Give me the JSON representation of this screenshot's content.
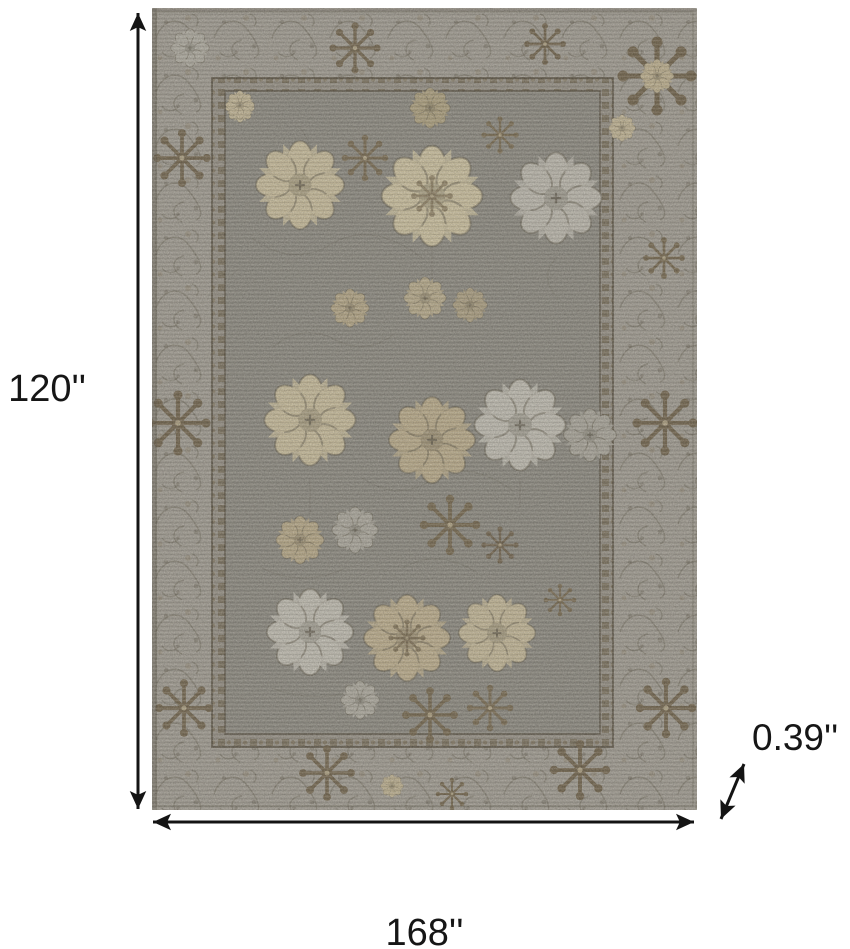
{
  "page": {
    "background_color": "#ffffff"
  },
  "diagram": {
    "kind": "product-dimension-diagram",
    "annotation_color": "#141414",
    "dimensions": {
      "height": {
        "label": "120''",
        "orientation": "vertical-left"
      },
      "width": {
        "label": "168''",
        "orientation": "horizontal-bottom"
      },
      "thickness": {
        "label": "0.39''",
        "orientation": "diagonal-bottom-right"
      }
    }
  },
  "rug": {
    "description": "gray and taupe oriental floral area rug with light gray vine border and cream, tan and brown medallions",
    "colors": {
      "border_band": "#a6a29a",
      "guard_band": "#98938a",
      "field": "#8e8c85",
      "outline": "#4d4536",
      "motif_cream": "#d5c8a5",
      "motif_tan": "#c1b190",
      "motif_brown": "#71624a",
      "motif_light_gray": "#c9c6bd"
    }
  }
}
